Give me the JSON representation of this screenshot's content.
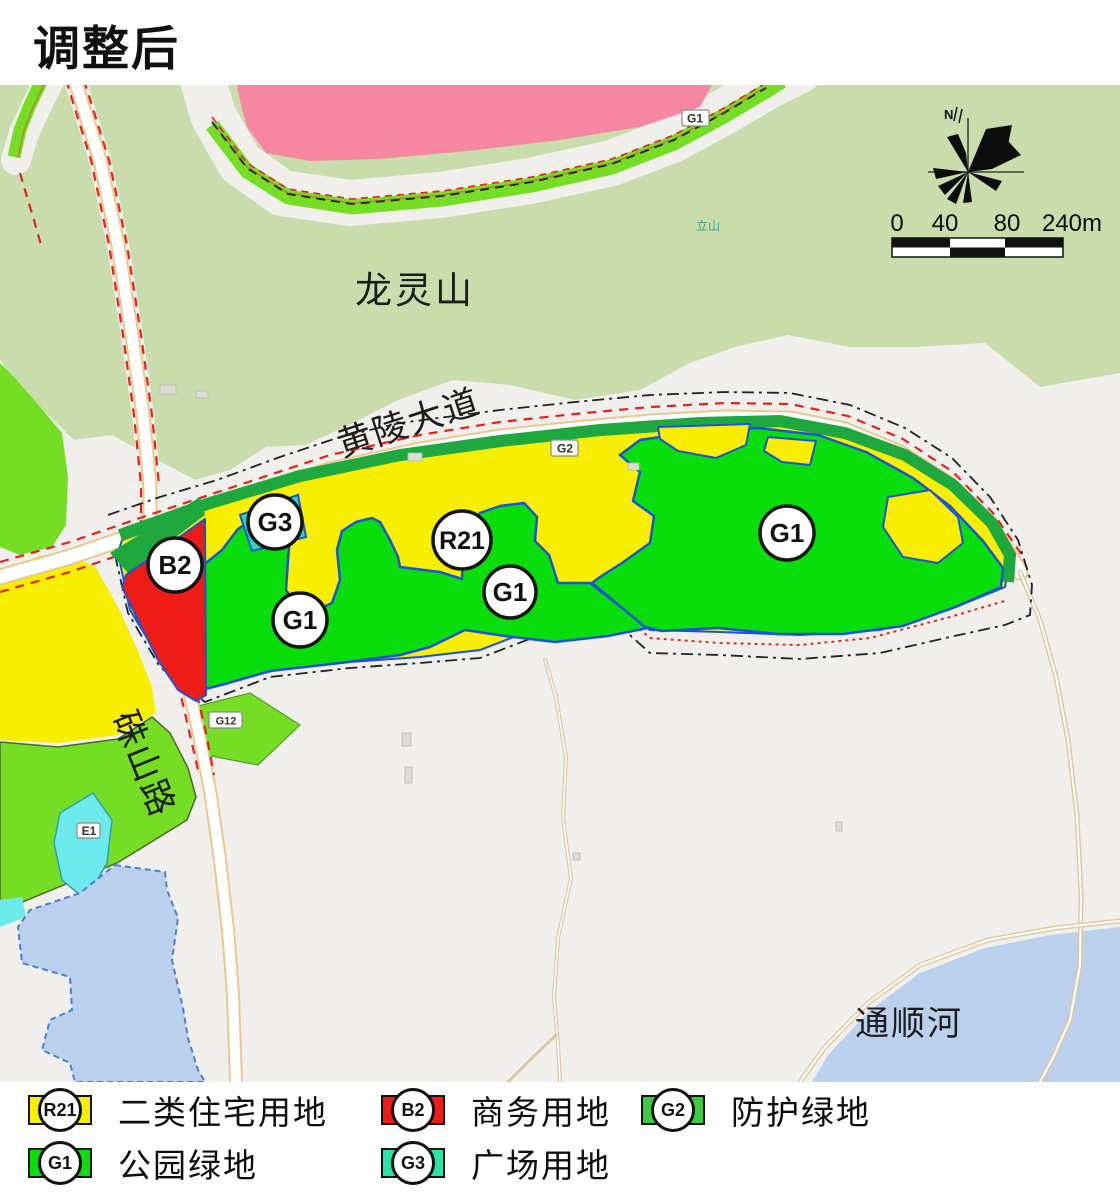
{
  "title": "调整后",
  "map": {
    "labels": {
      "mountain": "龙灵山",
      "avenue": "黄陵大道",
      "road": "硃山路",
      "river": "通顺河",
      "hill": "立山"
    },
    "circle_badges": [
      {
        "code": "B2"
      },
      {
        "code": "G3"
      },
      {
        "code": "R21"
      },
      {
        "code": "G1"
      },
      {
        "code": "G1"
      },
      {
        "code": "G1"
      }
    ],
    "square_badges": [
      {
        "code": "G1"
      },
      {
        "code": "G2"
      },
      {
        "code": "G12"
      },
      {
        "code": "E1"
      }
    ],
    "compass": {
      "north": "N"
    },
    "scale_bar": {
      "ticks": [
        "0",
        "40",
        "80",
        "240m"
      ]
    }
  },
  "legend": {
    "items": [
      {
        "code": "R21",
        "label": "二类住宅用地",
        "color": "#f8ee00"
      },
      {
        "code": "B2",
        "label": "商务用地",
        "color": "#ee1c16"
      },
      {
        "code": "G2",
        "label": "防护绿地",
        "color": "#3ecb41"
      },
      {
        "code": "G1",
        "label": "公园绿地",
        "color": "#0ade0a"
      },
      {
        "code": "G3",
        "label": "广场用地",
        "color": "#2be3a7"
      }
    ]
  },
  "colors": {
    "residential_yellow": "#f8ee00",
    "business_red": "#ee1c16",
    "park_green": "#0ade0a",
    "protective_green": "#1fa83e",
    "plaza_teal": "#2bd9ac",
    "mountain_green": "#c9dcab",
    "roadside_green": "#76dd25",
    "pink_zone": "#f687a0",
    "water_blue": "#bad0ed",
    "lake_cyan": "#6ce9ea",
    "background_gray": "#f1efec",
    "parcel_border_blue": "#1d52d8",
    "red_dash": "#e32219"
  }
}
